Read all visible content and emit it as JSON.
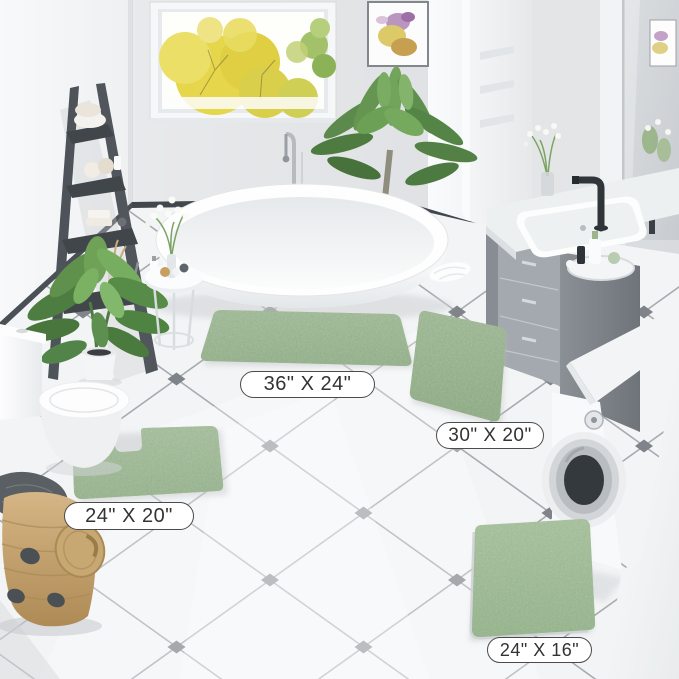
{
  "labels": {
    "rug_large": {
      "text": "36\" X 24\""
    },
    "rug_runner": {
      "text": "30\" X 20\""
    },
    "rug_contour": {
      "text": "24\" X 20\""
    },
    "rug_small": {
      "text": "24\" X 16\""
    }
  },
  "colors": {
    "rug_green": "#9cb893",
    "floor_tile": "#f3f4f5",
    "grout": "#a7abaf",
    "diamond_accent": "#7e8489",
    "baseboard": "#42474d",
    "label_border": "#4b4b4b",
    "label_text": "#333333",
    "label_bg": "#ffffff"
  },
  "scene_objects": [
    "window-autumn-trees",
    "framed-floral-art",
    "ladder-shelf-with-towels",
    "freestanding-bathtub",
    "floor-mount-tub-faucet",
    "side-table-with-vase",
    "banana-leaf-plant",
    "palm-plant",
    "toilet",
    "contour-rug",
    "large-rug",
    "runner-rug",
    "small-rug",
    "woven-basket-with-lid",
    "vanity-sink-black-faucet",
    "mirror",
    "washing-machine",
    "diamond-accent-tile-floor"
  ]
}
